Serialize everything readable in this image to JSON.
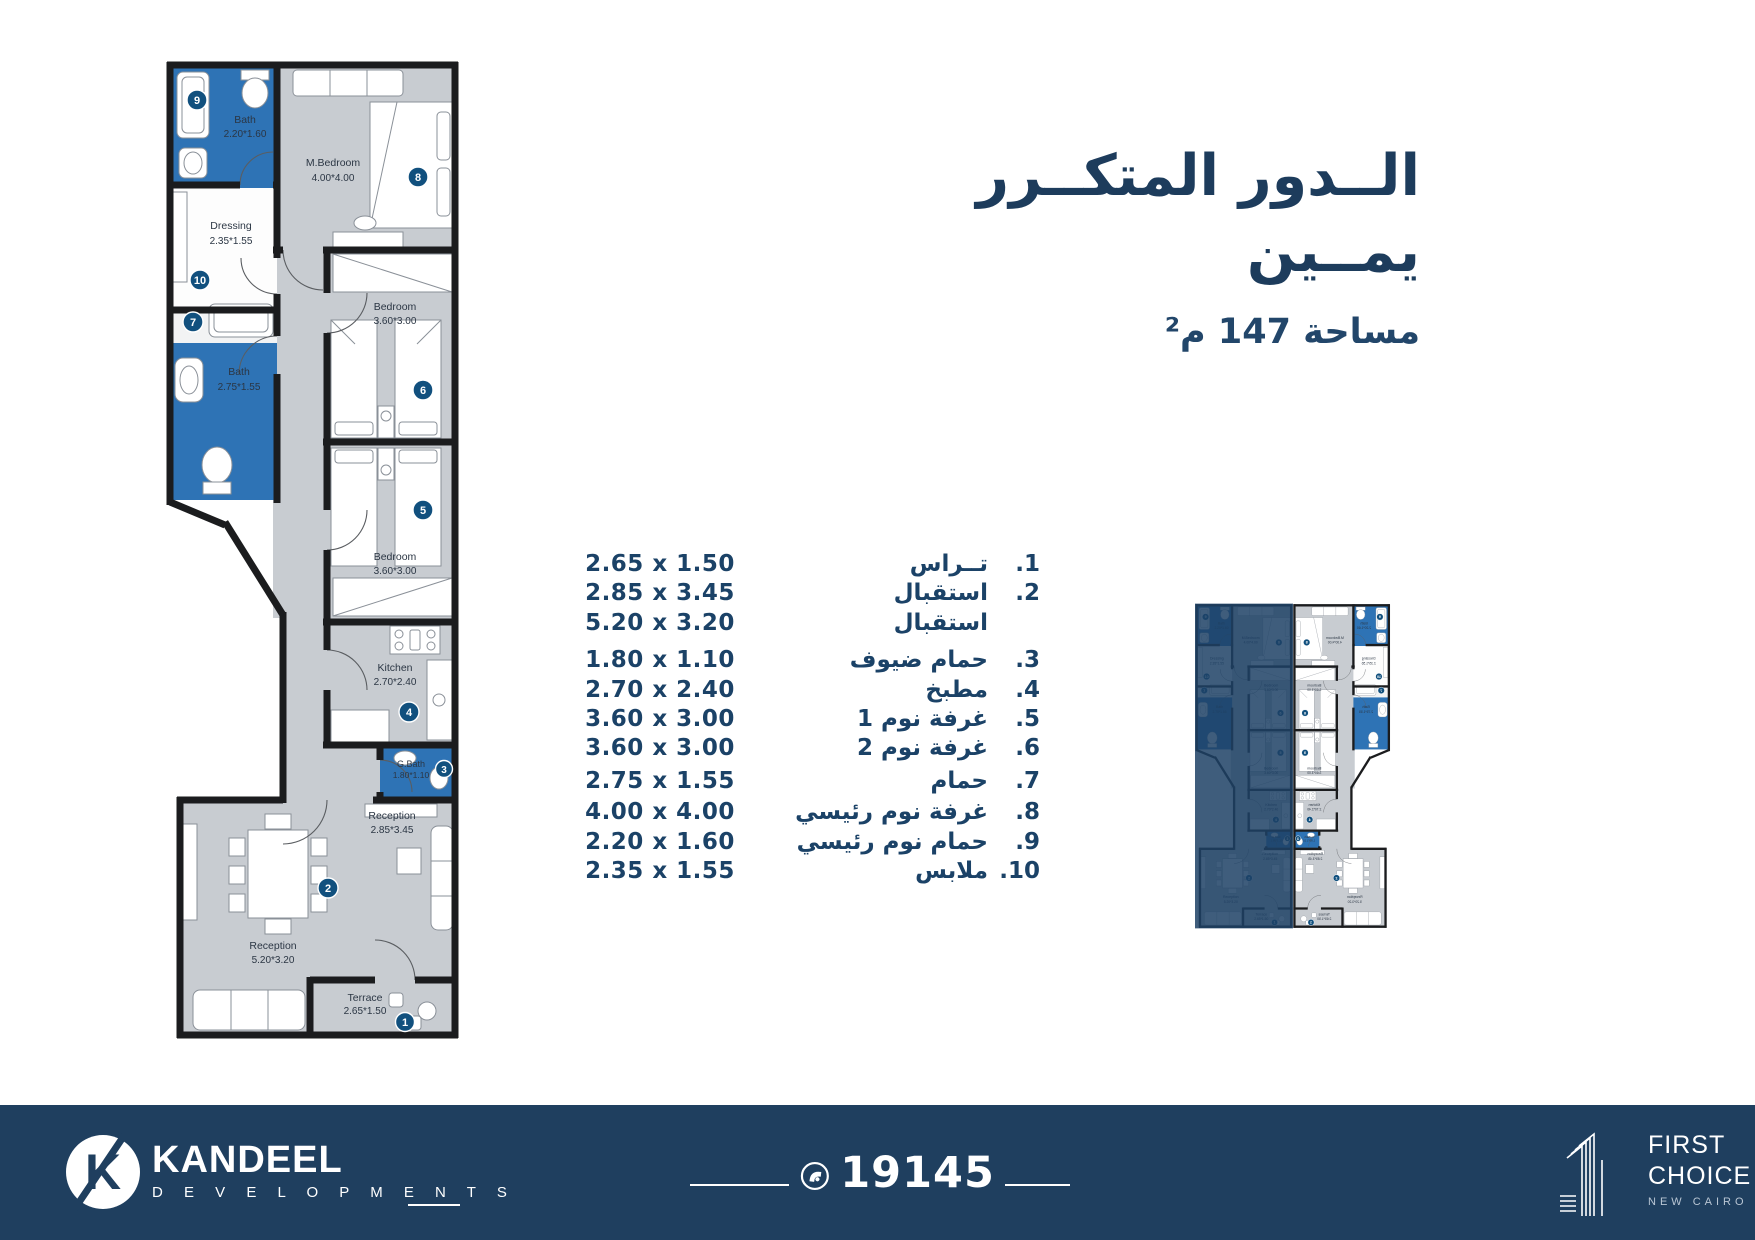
{
  "title": {
    "line1": "الــدور المتكــرر",
    "line2": "يمــين",
    "area": "مساحة 147 م²"
  },
  "legend": {
    "rows": [
      {
        "no": "1.",
        "name": "تــراس",
        "dims": "2.65 x 1.50"
      },
      {
        "no": "2.",
        "name": "استقبال",
        "dims": "2.85 x 3.45"
      },
      {
        "no": "",
        "name": "استقبال",
        "dims": "5.20 x 3.20"
      },
      {
        "no": "3.",
        "name": "حمام ضيوف",
        "dims": "1.80 x 1.10"
      },
      {
        "no": "4.",
        "name": "مطبخ",
        "dims": "2.70 x 2.40"
      },
      {
        "no": "5.",
        "name": "غرفة نوم 1",
        "dims": "3.60 x 3.00"
      },
      {
        "no": "6.",
        "name": "غرفة نوم 2",
        "dims": "3.60 x 3.00"
      },
      {
        "no": "7.",
        "name": "حمام",
        "dims": "2.75 x 1.55"
      },
      {
        "no": "8.",
        "name": "غرفة نوم رئيسي",
        "dims": "4.00 x 4.00"
      },
      {
        "no": "9.",
        "name": "حمام نوم رئيسي",
        "dims": "2.20 x 1.60"
      },
      {
        "no": "10.",
        "name": "ملابس",
        "dims": "2.35 x 1.55"
      }
    ]
  },
  "plan": {
    "rooms": [
      {
        "num": "1",
        "label": "Terrace",
        "dims": "2.65*1.50"
      },
      {
        "num": "2",
        "label": "Reception",
        "dims": "2.85*3.45"
      },
      {
        "num": "",
        "label": "Reception",
        "dims": "5.20*3.20"
      },
      {
        "num": "3",
        "label": "G.Bath",
        "dims": "1.80*1.10"
      },
      {
        "num": "4",
        "label": "Kitchen",
        "dims": "2.70*2.40"
      },
      {
        "num": "5",
        "label": "Bedroom",
        "dims": "3.60*3.00"
      },
      {
        "num": "6",
        "label": "Bedroom",
        "dims": "3.60*3.00"
      },
      {
        "num": "7",
        "label": "Bath",
        "dims": "2.75*1.55"
      },
      {
        "num": "8",
        "label": "M.Bedroom",
        "dims": "4.00*4.00"
      },
      {
        "num": "9",
        "label": "Bath",
        "dims": "2.20*1.60"
      },
      {
        "num": "10",
        "label": "Dressing",
        "dims": "2.35*1.55"
      }
    ]
  },
  "footer": {
    "brand": "KANDEEL",
    "brand_sub": "D E V E L O P M E N T S",
    "brand_letter": "K",
    "phone": "19145",
    "partner_line1": "FIRST",
    "partner_line2": "CHOICE",
    "partner_sub": "NEW CAIRO"
  },
  "colors": {
    "navy_text": "#1d3c5c",
    "list_blue": "#1b4267",
    "bath_blue": "#2e73b5",
    "room_gray": "#c8ccd1",
    "wall_dark": "#1b1c1e",
    "circle_navy": "#11507e",
    "footer_navy": "#1f3f5f",
    "thumb_highlight": "#1d4165"
  }
}
